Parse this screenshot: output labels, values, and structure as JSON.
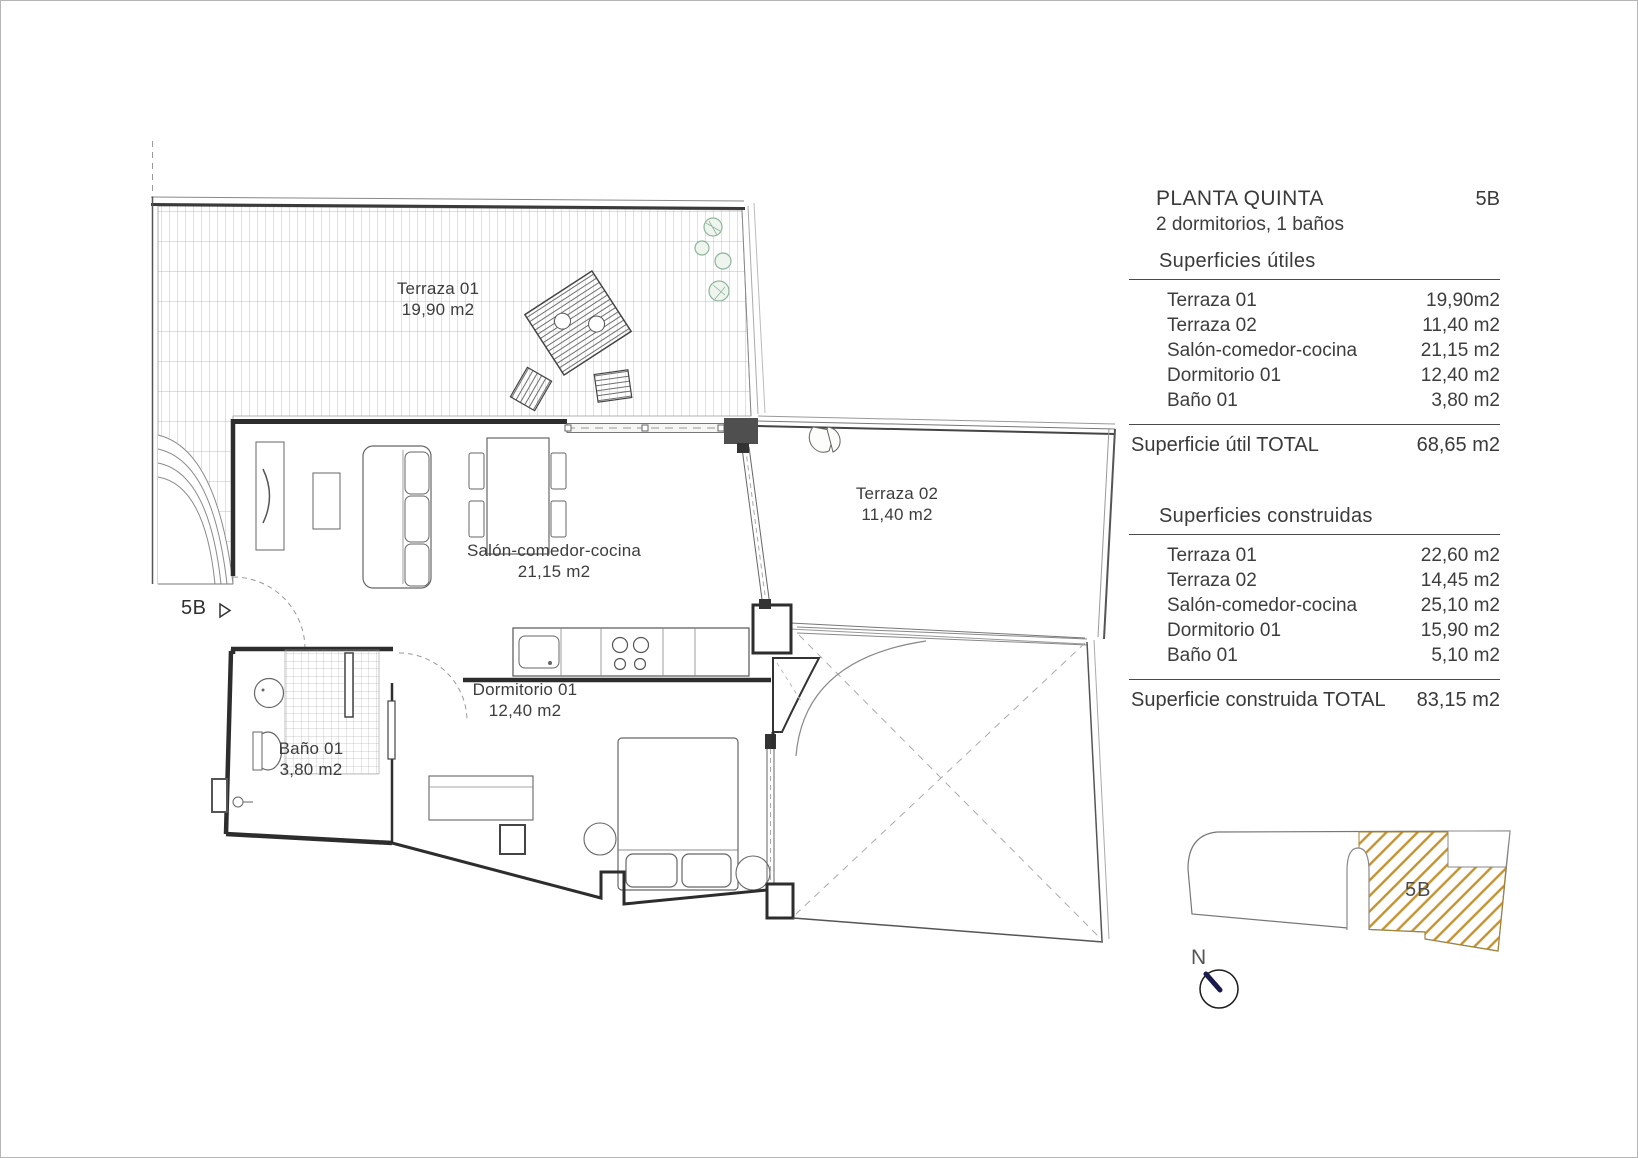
{
  "panel": {
    "title": "PLANTA QUINTA",
    "unit": "5B",
    "subtitle": "2 dormitorios, 1 baños",
    "useful": {
      "heading": "Superficies útiles",
      "rows": [
        {
          "label": "Terraza 01",
          "value": "19,90m2"
        },
        {
          "label": "Terraza 02",
          "value": "11,40 m2"
        },
        {
          "label": "Salón-comedor-cocina",
          "value": "21,15 m2"
        },
        {
          "label": "Dormitorio 01",
          "value": "12,40 m2"
        },
        {
          "label": "Baño 01",
          "value": "3,80 m2"
        }
      ],
      "total_label": "Superficie útil TOTAL",
      "total_value": "68,65 m2"
    },
    "built": {
      "heading": "Superficies  construidas",
      "rows": [
        {
          "label": "Terraza 01",
          "value": "22,60 m2"
        },
        {
          "label": "Terraza 02",
          "value": "14,45 m2"
        },
        {
          "label": "Salón-comedor-cocina",
          "value": "25,10 m2"
        },
        {
          "label": "Dormitorio 01",
          "value": "15,90 m2"
        },
        {
          "label": "Baño 01",
          "value": "5,10 m2"
        }
      ],
      "total_label": "Superficie construida TOTAL",
      "total_value": "83,15 m2"
    }
  },
  "plan": {
    "entrance_label": "5B",
    "rooms": [
      {
        "name": "Terraza 01",
        "area": "19,90 m2"
      },
      {
        "name": "Salón-comedor-cocina",
        "area": "21,15 m2"
      },
      {
        "name": "Terraza 02",
        "area": "11,40 m2"
      },
      {
        "name": "Dormitorio 01",
        "area": "12,40 m2"
      },
      {
        "name": "Baño 01",
        "area": "3,80 m2"
      }
    ]
  },
  "minimap": {
    "unit_label": "5B",
    "north_label": "N",
    "hatch_color": "#c3922e"
  }
}
